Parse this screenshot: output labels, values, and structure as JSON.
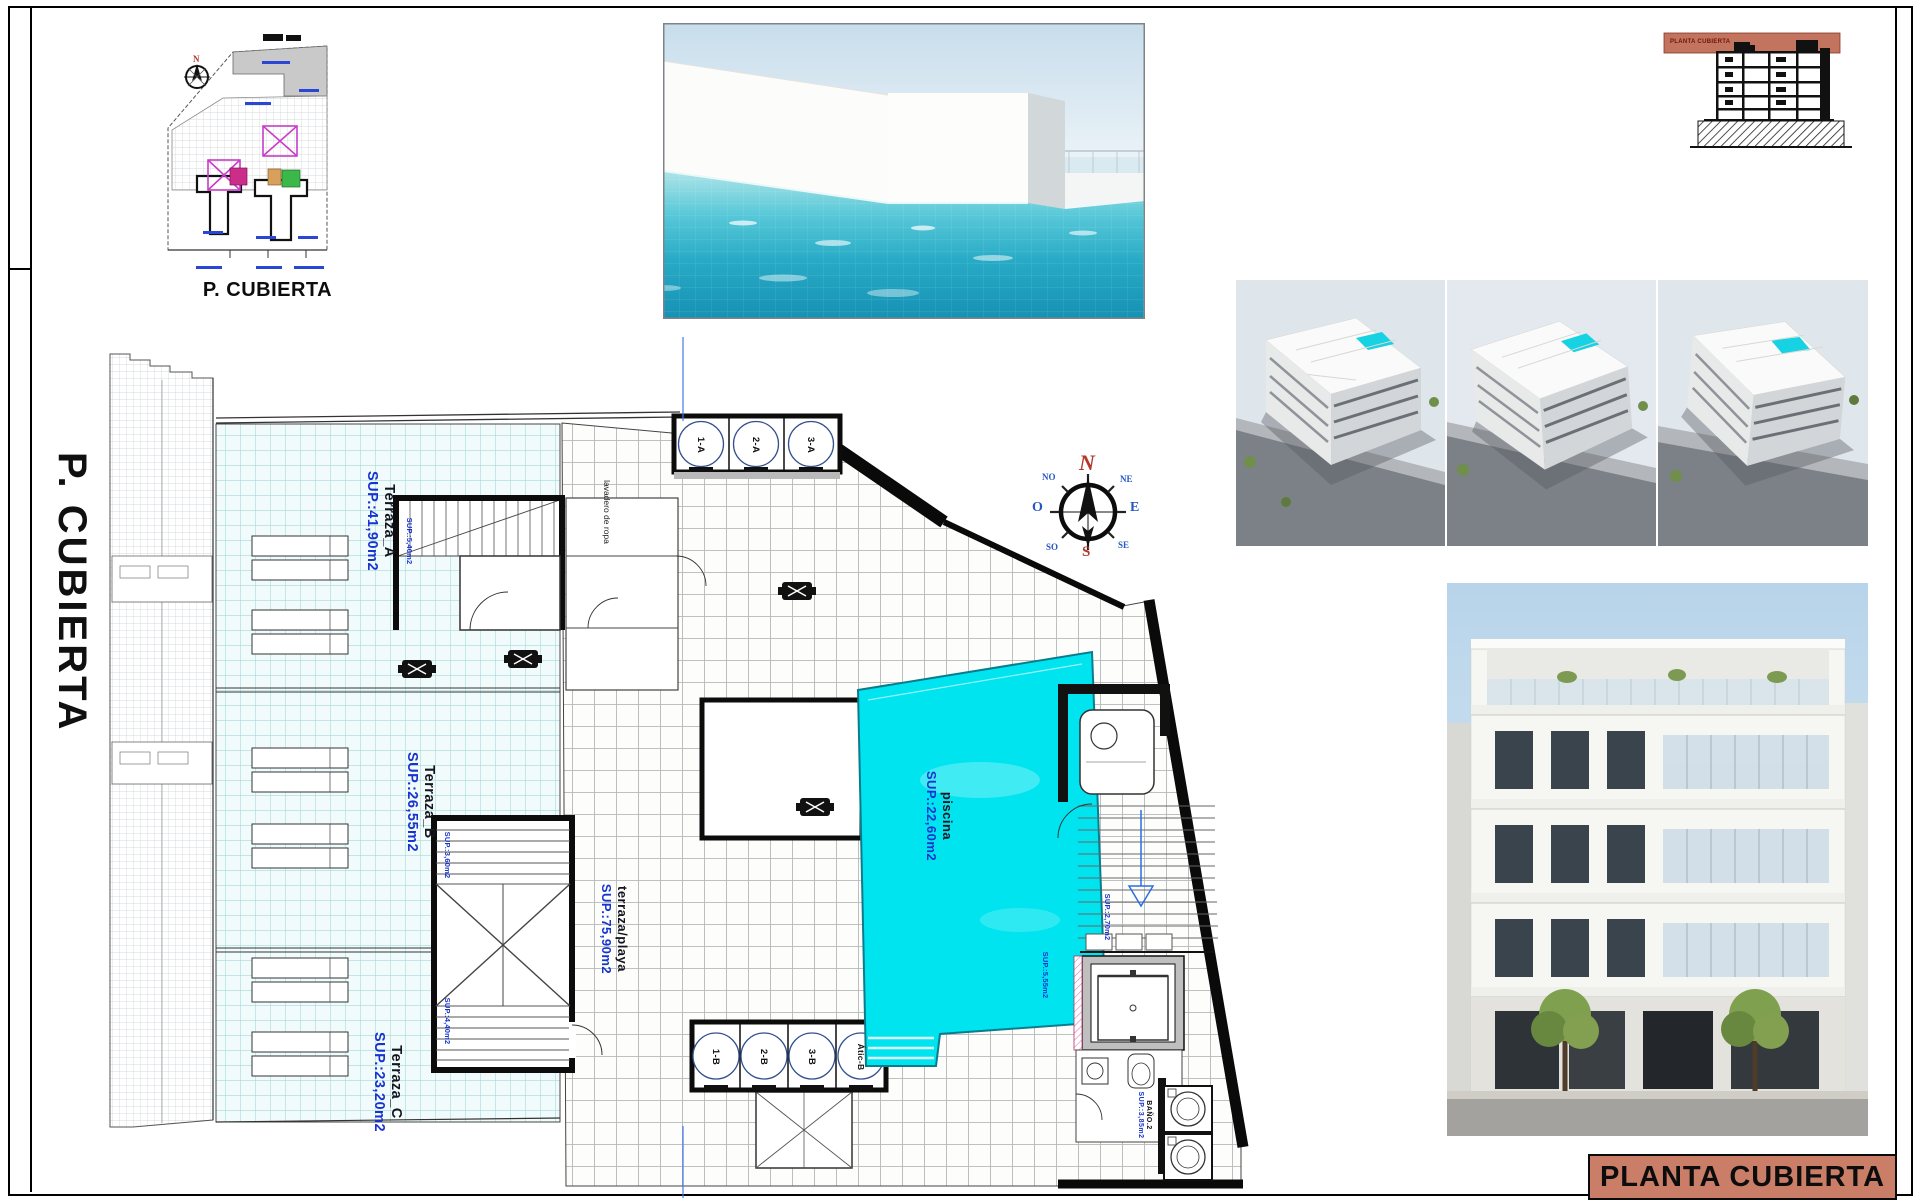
{
  "sheet": {
    "side_title": "P. CUBIERTA",
    "key_plan_caption": "P. CUBIERTA",
    "title_block": "PLANTA CUBIERTA",
    "section_band_label": "PLANTA CUBIERTA"
  },
  "plan": {
    "areas": {
      "terraza_a": {
        "name": "Terraza_A",
        "sup": "SUP.:41,90m2"
      },
      "terraza_b": {
        "name": "Terraza_B",
        "sup": "SUP.:26,55m2"
      },
      "terraza_c": {
        "name": "Terraza_C",
        "sup": "SUP.:23,20m2"
      },
      "terraza_playa": {
        "name": "terraza/playa",
        "sup": "SUP.:75,90m2"
      },
      "piscina": {
        "name": "piscina",
        "sup": "SUP.:22,60m2"
      },
      "bano2": {
        "name": "BAÑO.2",
        "sup": "SUP.:3,85m2"
      }
    },
    "small_labels": {
      "laundry": "lavadero de ropa",
      "stair_top": "SUP.:5,40m2",
      "stair_bottom_a": "SUP.:3,60m2",
      "stair_bottom_b": "SUP.:4,40m2",
      "stair_right": "SUP.:2,70m2",
      "lift_side": "SUP.:5,55m2"
    },
    "roof_units_top": [
      "1-A",
      "2-A",
      "3-A"
    ],
    "roof_units_bottom": [
      "1-B",
      "2-B",
      "3-B",
      "Átic-B"
    ]
  },
  "compass": {
    "n": "N",
    "s": "S",
    "e": "E",
    "w": "O",
    "ne": "NE",
    "se": "SE",
    "sw": "SO",
    "nw": "NO"
  },
  "colors": {
    "pool": "#00e4f0",
    "title_block_bg": "#ca7e68",
    "section_band_bg": "#c3745e",
    "label_blue": "#1734cf"
  }
}
